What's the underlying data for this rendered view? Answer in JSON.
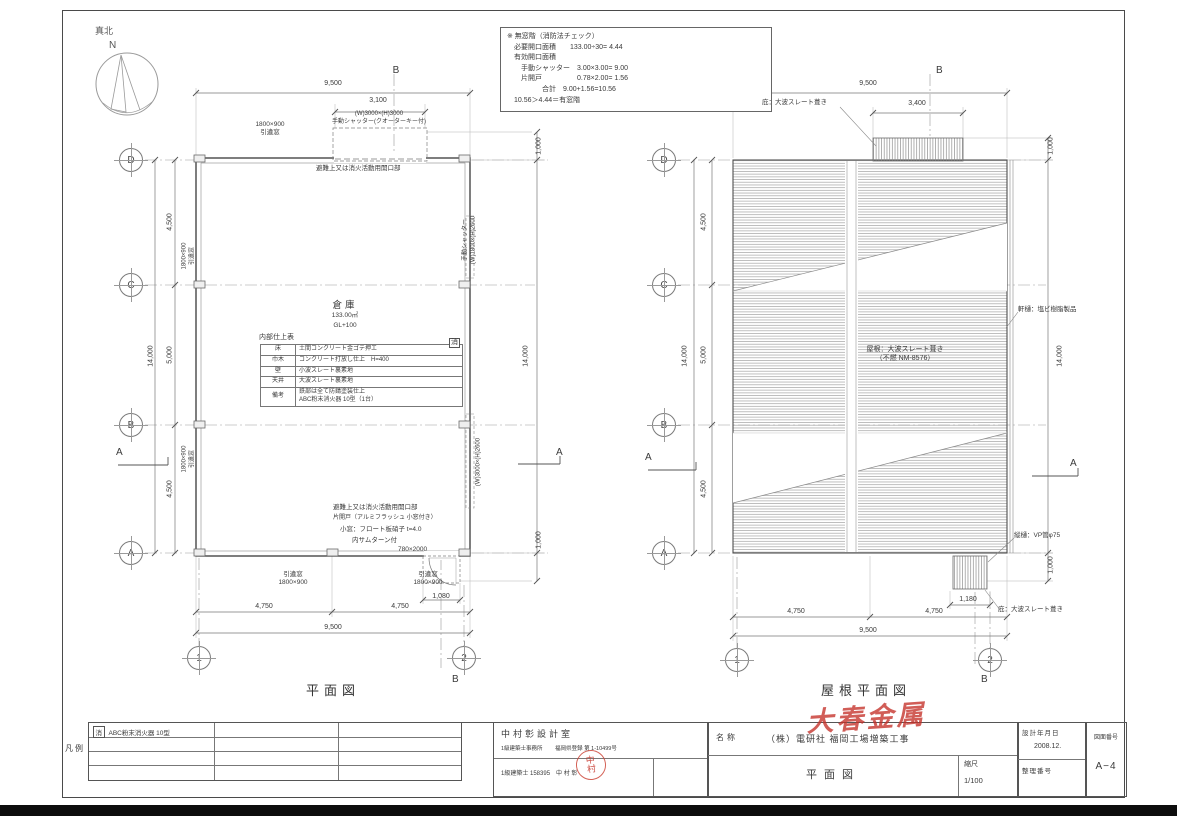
{
  "colors": {
    "line": "#5a5a5a",
    "text": "#3a3a3a",
    "red_stamp": "#c8463a"
  },
  "compass": {
    "true_north": "真北",
    "n": "N"
  },
  "note_box": {
    "lines": [
      "※ 無窓階（消防法チェック）",
      "　必要開口面積　　133.00÷30= 4.44",
      "　有効開口面積",
      "　　手動シャッター　3.00×3.00= 9.00",
      "　　片開戸　　　　　0.78×2.00= 1.56",
      "　　　　　合計　9.00+1.56=10.56",
      "　10.56＞4.44＝有窓階"
    ]
  },
  "floor_plan": {
    "caption": "平面図",
    "room": {
      "name": "倉庫",
      "area": "133.00㎡",
      "level": "GL+100"
    },
    "finish_table": {
      "title": "内部仕上表",
      "rows": [
        {
          "item": "床",
          "spec": "土間コンクリート金ゴテ押エ"
        },
        {
          "item": "巾木",
          "spec": "コンクリート打放し仕上　H=400"
        },
        {
          "item": "壁",
          "spec": "小波スレート裏素地"
        },
        {
          "item": "天井",
          "spec": "大波スレート裏素地"
        },
        {
          "item": "備考",
          "spec": "鉄部は全て防錆塗装仕上\nABC粉末消火器 10型（1台）"
        }
      ]
    },
    "grids": [
      {
        "t": "D",
        "x": 131,
        "y": 160
      },
      {
        "t": "C",
        "x": 131,
        "y": 285
      },
      {
        "t": "B",
        "x": 131,
        "y": 425
      },
      {
        "t": "A",
        "x": 131,
        "y": 553
      },
      {
        "t": "1",
        "x": 199,
        "y": 658
      },
      {
        "t": "2",
        "x": 464,
        "y": 658
      }
    ],
    "annotations": [
      {
        "t": "9,500",
        "x": 333,
        "y": 80,
        "a": "c"
      },
      {
        "t": "3,100",
        "x": 378,
        "y": 97,
        "a": "c"
      },
      {
        "t": "B",
        "x": 396,
        "y": 65,
        "a": "c",
        "s": 10
      },
      {
        "t": "1800×900\n引違窓",
        "x": 270,
        "y": 121,
        "a": "c",
        "s": 6.5
      },
      {
        "t": "(W)3000×(H)3000\n手動シャッター(クオーターキー付)",
        "x": 379,
        "y": 111,
        "a": "c",
        "s": 6
      },
      {
        "t": "避難上又は消火活動用開口部",
        "x": 316,
        "y": 165,
        "s": 6.5
      },
      {
        "t": "4,500",
        "x": 171,
        "y": 222,
        "rot": -90
      },
      {
        "t": "5,000",
        "x": 171,
        "y": 355,
        "rot": -90
      },
      {
        "t": "4,500",
        "x": 171,
        "y": 489,
        "rot": -90
      },
      {
        "t": "14,000",
        "x": 152,
        "y": 356,
        "rot": -90
      },
      {
        "t": "1800×900\n引違窓",
        "x": 189,
        "y": 256,
        "rot": -90,
        "s": 6
      },
      {
        "t": "1800×900\n引違窓",
        "x": 189,
        "y": 459,
        "rot": -90,
        "s": 6
      },
      {
        "t": "A",
        "x": 116,
        "y": 447,
        "s": 10
      },
      {
        "t": "A",
        "x": 556,
        "y": 447,
        "s": 10
      },
      {
        "t": "1,000",
        "x": 540,
        "y": 146,
        "rot": -90
      },
      {
        "t": "14,000",
        "x": 527,
        "y": 356,
        "rot": -90
      },
      {
        "t": "1,000",
        "x": 540,
        "y": 540,
        "rot": -90
      },
      {
        "t": "手動シャッター\n(W)1800×(H)2600",
        "x": 470,
        "y": 240,
        "rot": -90,
        "s": 6
      },
      {
        "t": "(W)3000×(H)2600",
        "x": 479,
        "y": 462,
        "rot": -90,
        "s": 6
      },
      {
        "t": "消",
        "x": 449,
        "y": 338,
        "cls": "boxed",
        "s": 7
      },
      {
        "t": "内部仕上表",
        "x": 259,
        "y": 334,
        "s": 7
      },
      {
        "t": "避難上又は消火活動用開口部",
        "x": 333,
        "y": 504,
        "s": 6.5
      },
      {
        "t": "片開戸（アルミフラッシュ 小窓付き）",
        "x": 333,
        "y": 515,
        "s": 6
      },
      {
        "t": "小窓：フロート板硝子 t=4.0",
        "x": 340,
        "y": 526,
        "s": 6.5
      },
      {
        "t": "内サムターン付",
        "x": 352,
        "y": 537,
        "s": 6.5
      },
      {
        "t": "780×2000",
        "x": 398,
        "y": 546,
        "s": 6.5
      },
      {
        "t": "引違窓\n1800×900",
        "x": 293,
        "y": 571,
        "a": "c",
        "s": 6.5
      },
      {
        "t": "引違窓\n1800×900",
        "x": 428,
        "y": 571,
        "a": "c",
        "s": 6.5
      },
      {
        "t": "1,080",
        "x": 441,
        "y": 593,
        "a": "c"
      },
      {
        "t": "4,750",
        "x": 264,
        "y": 603,
        "a": "c"
      },
      {
        "t": "4,750",
        "x": 400,
        "y": 603,
        "a": "c"
      },
      {
        "t": "9,500",
        "x": 333,
        "y": 624,
        "a": "c"
      },
      {
        "t": "B",
        "x": 452,
        "y": 674,
        "s": 10
      }
    ]
  },
  "roof_plan": {
    "caption": "屋根平面図",
    "grids": [
      {
        "t": "D",
        "x": 664,
        "y": 160
      },
      {
        "t": "C",
        "x": 664,
        "y": 285
      },
      {
        "t": "B",
        "x": 664,
        "y": 425
      },
      {
        "t": "A",
        "x": 664,
        "y": 553
      },
      {
        "t": "1",
        "x": 737,
        "y": 660
      },
      {
        "t": "2",
        "x": 990,
        "y": 660
      }
    ],
    "annotations": [
      {
        "t": "9,500",
        "x": 868,
        "y": 80,
        "a": "c"
      },
      {
        "t": "3,400",
        "x": 917,
        "y": 100,
        "a": "c"
      },
      {
        "t": "B",
        "x": 936,
        "y": 65,
        "s": 10
      },
      {
        "t": "庇：大波スレート葺き",
        "x": 762,
        "y": 99,
        "s": 6.5
      },
      {
        "t": "4,500",
        "x": 705,
        "y": 222,
        "rot": -90
      },
      {
        "t": "5,000",
        "x": 705,
        "y": 355,
        "rot": -90
      },
      {
        "t": "4,500",
        "x": 705,
        "y": 489,
        "rot": -90
      },
      {
        "t": "14,000",
        "x": 686,
        "y": 356,
        "rot": -90
      },
      {
        "t": "A",
        "x": 645,
        "y": 452,
        "s": 10
      },
      {
        "t": "A",
        "x": 1070,
        "y": 458,
        "s": 10
      },
      {
        "t": "1,000",
        "x": 1052,
        "y": 146,
        "rot": -90
      },
      {
        "t": "軒樋：塩ビ樹脂製品",
        "x": 1018,
        "y": 306,
        "s": 6.5
      },
      {
        "t": "14,000",
        "x": 1061,
        "y": 356,
        "rot": -90
      },
      {
        "t": "屋根：大波スレート葺き\n（不燃 NM-8576）",
        "x": 905,
        "y": 346,
        "a": "c",
        "s": 7
      },
      {
        "t": "縦樋：VP管φ75",
        "x": 1014,
        "y": 532,
        "s": 6.5
      },
      {
        "t": "1,000",
        "x": 1052,
        "y": 565,
        "rot": -90
      },
      {
        "t": "1,180",
        "x": 968,
        "y": 596,
        "a": "c"
      },
      {
        "t": "庇：大波スレート葺き",
        "x": 998,
        "y": 606,
        "s": 6.5
      },
      {
        "t": "4,750",
        "x": 796,
        "y": 608,
        "a": "c"
      },
      {
        "t": "4,750",
        "x": 934,
        "y": 608,
        "a": "c"
      },
      {
        "t": "9,500",
        "x": 868,
        "y": 627,
        "a": "c"
      },
      {
        "t": "B",
        "x": 981,
        "y": 674,
        "s": 10
      }
    ]
  },
  "title_block": {
    "legend_label": "凡例",
    "legend_symbol": "消",
    "legend_item": "ABC粉末消火器 10型",
    "office_name": "中村彰設計室",
    "office_type": "1級建築士事務所",
    "office_reg": "福岡県登録 第 1-10499号",
    "architect": "1級建築士 158395　中 村 彰",
    "stamp": "中\n村",
    "name_label": "名称",
    "project": "（株）電研社 福岡工場増築工事",
    "red_note": "大春金属",
    "drawing_title": "平面図",
    "scale_label": "縮尺",
    "scale_value": "1/100",
    "date_label": "設計年月日",
    "date_value": "2008.12.",
    "seiri_label": "整理番号",
    "sheet_label": "図面番号",
    "sheet_value": "A−4"
  }
}
